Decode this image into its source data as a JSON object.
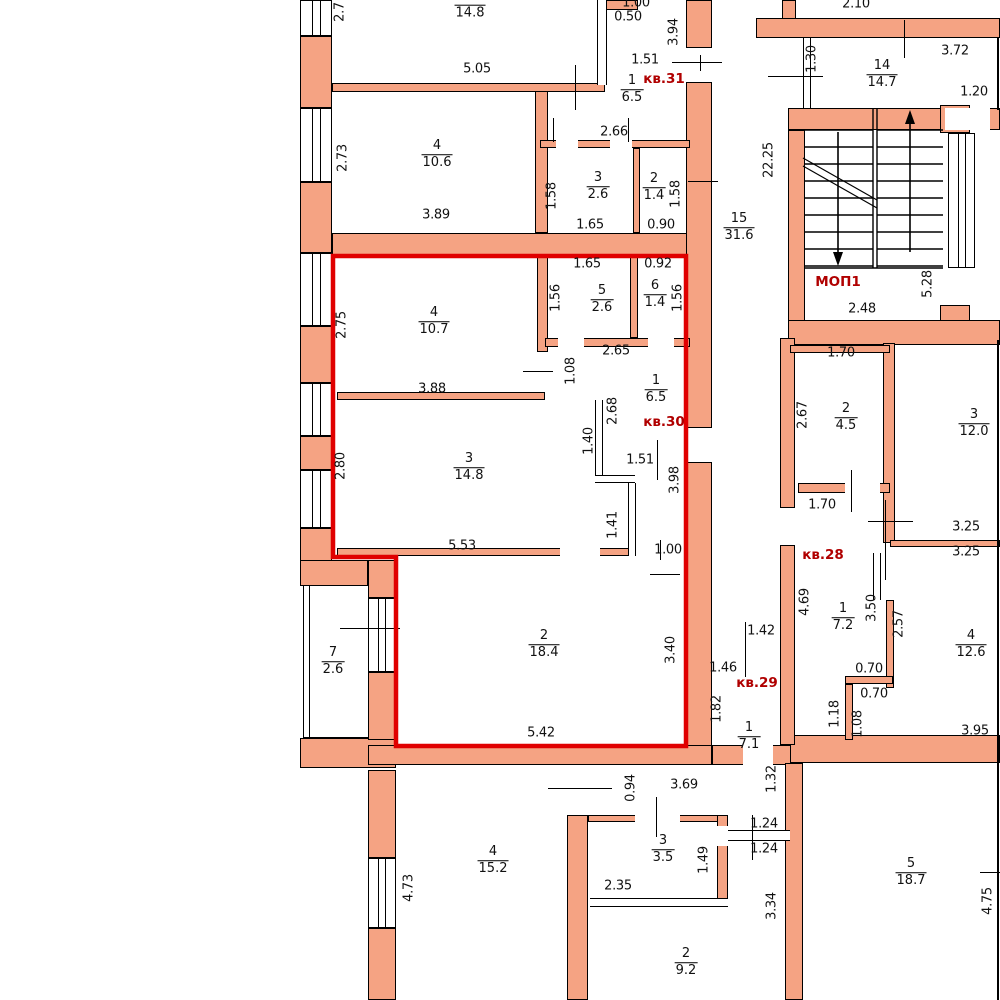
{
  "drawing": {
    "kind": "floor-plan",
    "language": "ru",
    "highlighted_apartment": "кв.30"
  },
  "colors": {
    "background": "#FFFFFF",
    "wall": "#F5A383",
    "outline": "#000000",
    "highlight": "#E00000",
    "tag": "#B00000"
  },
  "apartment_tags": [
    {
      "text": "кв.31",
      "x": 664,
      "y": 79
    },
    {
      "text": "кв.30",
      "x": 664,
      "y": 422
    },
    {
      "text": "кв.29",
      "x": 757,
      "y": 683
    },
    {
      "text": "кв.28",
      "x": 823,
      "y": 555
    },
    {
      "text": "МОП1",
      "x": 838,
      "y": 282
    }
  ],
  "room_labels": [
    {
      "num": "",
      "area": "14.8",
      "x": 470,
      "y": 13
    },
    {
      "num": "1",
      "area": "6.5",
      "x": 632,
      "y": 90
    },
    {
      "num": "4",
      "area": "10.6",
      "x": 437,
      "y": 155
    },
    {
      "num": "3",
      "area": "2.6",
      "x": 598,
      "y": 187
    },
    {
      "num": "2",
      "area": "1.4",
      "x": 654,
      "y": 188
    },
    {
      "num": "14",
      "area": "14.7",
      "x": 882,
      "y": 75
    },
    {
      "num": "15",
      "area": "31.6",
      "x": 739,
      "y": 228
    },
    {
      "num": "5",
      "area": "2.6",
      "x": 602,
      "y": 300
    },
    {
      "num": "6",
      "area": "1.4",
      "x": 655,
      "y": 295
    },
    {
      "num": "4",
      "area": "10.7",
      "x": 434,
      "y": 322
    },
    {
      "num": "1",
      "area": "6.5",
      "x": 656,
      "y": 390
    },
    {
      "num": "3",
      "area": "14.8",
      "x": 469,
      "y": 468
    },
    {
      "num": "2",
      "area": "18.4",
      "x": 544,
      "y": 645
    },
    {
      "num": "7",
      "area": "2.6",
      "x": 333,
      "y": 662
    },
    {
      "num": "2",
      "area": "4.5",
      "x": 846,
      "y": 418
    },
    {
      "num": "3",
      "area": "12.0",
      "x": 974,
      "y": 424
    },
    {
      "num": "1",
      "area": "7.2",
      "x": 843,
      "y": 618
    },
    {
      "num": "4",
      "area": "12.6",
      "x": 971,
      "y": 645
    },
    {
      "num": "1",
      "area": "7.1",
      "x": 749,
      "y": 737
    },
    {
      "num": "4",
      "area": "15.2",
      "x": 493,
      "y": 861
    },
    {
      "num": "3",
      "area": "3.5",
      "x": 663,
      "y": 850
    },
    {
      "num": "2",
      "area": "9.2",
      "x": 686,
      "y": 963
    },
    {
      "num": "5",
      "area": "18.7",
      "x": 911,
      "y": 873
    }
  ],
  "dim_labels": [
    {
      "text": "1.00",
      "x": 636,
      "y": 3,
      "rot": false
    },
    {
      "text": "0.50",
      "x": 628,
      "y": 17,
      "rot": false
    },
    {
      "text": "3.94",
      "x": 674,
      "y": 32,
      "rot": true
    },
    {
      "text": "1.51",
      "x": 645,
      "y": 60,
      "rot": false
    },
    {
      "text": "2.7",
      "x": 340,
      "y": 12,
      "rot": true
    },
    {
      "text": "5.05",
      "x": 477,
      "y": 69,
      "rot": false
    },
    {
      "text": "2.66",
      "x": 614,
      "y": 132,
      "rot": false
    },
    {
      "text": "2.73",
      "x": 343,
      "y": 158,
      "rot": true
    },
    {
      "text": "3.89",
      "x": 436,
      "y": 215,
      "rot": false
    },
    {
      "text": "1.58",
      "x": 552,
      "y": 196,
      "rot": true
    },
    {
      "text": "1.65",
      "x": 590,
      "y": 225,
      "rot": false
    },
    {
      "text": "0.90",
      "x": 661,
      "y": 225,
      "rot": false
    },
    {
      "text": "1.58",
      "x": 676,
      "y": 194,
      "rot": true
    },
    {
      "text": "2.10",
      "x": 856,
      "y": 4,
      "rot": false
    },
    {
      "text": "1.30",
      "x": 812,
      "y": 59,
      "rot": true
    },
    {
      "text": "3.72",
      "x": 955,
      "y": 51,
      "rot": false
    },
    {
      "text": "1.20",
      "x": 974,
      "y": 92,
      "rot": false
    },
    {
      "text": "22.25",
      "x": 769,
      "y": 160,
      "rot": true
    },
    {
      "text": "2.48",
      "x": 862,
      "y": 309,
      "rot": false
    },
    {
      "text": "5.28",
      "x": 928,
      "y": 284,
      "rot": true
    },
    {
      "text": "1.65",
      "x": 587,
      "y": 264,
      "rot": false
    },
    {
      "text": "0.92",
      "x": 658,
      "y": 264,
      "rot": false
    },
    {
      "text": "1.56",
      "x": 556,
      "y": 298,
      "rot": true
    },
    {
      "text": "1.56",
      "x": 678,
      "y": 298,
      "rot": true
    },
    {
      "text": "2.75",
      "x": 342,
      "y": 325,
      "rot": true
    },
    {
      "text": "2.65",
      "x": 616,
      "y": 351,
      "rot": false
    },
    {
      "text": "3.88",
      "x": 432,
      "y": 389,
      "rot": false
    },
    {
      "text": "1.08",
      "x": 571,
      "y": 371,
      "rot": true
    },
    {
      "text": "2.68",
      "x": 613,
      "y": 411,
      "rot": true
    },
    {
      "text": "2.80",
      "x": 341,
      "y": 466,
      "rot": true
    },
    {
      "text": "1.40",
      "x": 589,
      "y": 441,
      "rot": true
    },
    {
      "text": "1.51",
      "x": 640,
      "y": 460,
      "rot": false
    },
    {
      "text": "3.98",
      "x": 675,
      "y": 480,
      "rot": true
    },
    {
      "text": "1.41",
      "x": 613,
      "y": 525,
      "rot": true
    },
    {
      "text": "5.53",
      "x": 462,
      "y": 546,
      "rot": false
    },
    {
      "text": "1.00",
      "x": 668,
      "y": 550,
      "rot": false
    },
    {
      "text": "3.40",
      "x": 671,
      "y": 650,
      "rot": true
    },
    {
      "text": "5.42",
      "x": 541,
      "y": 733,
      "rot": false
    },
    {
      "text": "1.42",
      "x": 761,
      "y": 631,
      "rot": false
    },
    {
      "text": "1.46",
      "x": 723,
      "y": 668,
      "rot": false
    },
    {
      "text": "1.82",
      "x": 717,
      "y": 709,
      "rot": true
    },
    {
      "text": "1.32",
      "x": 772,
      "y": 779,
      "rot": true
    },
    {
      "text": "0.94",
      "x": 631,
      "y": 788,
      "rot": true
    },
    {
      "text": "3.69",
      "x": 684,
      "y": 785,
      "rot": false
    },
    {
      "text": "4.73",
      "x": 409,
      "y": 888,
      "rot": true
    },
    {
      "text": "2.35",
      "x": 618,
      "y": 886,
      "rot": false
    },
    {
      "text": "1.49",
      "x": 704,
      "y": 860,
      "rot": true
    },
    {
      "text": "1.24",
      "x": 764,
      "y": 824,
      "rot": false
    },
    {
      "text": "1.24",
      "x": 764,
      "y": 849,
      "rot": false
    },
    {
      "text": "3.34",
      "x": 772,
      "y": 906,
      "rot": true
    },
    {
      "text": "1.70",
      "x": 841,
      "y": 353,
      "rot": false
    },
    {
      "text": "2.67",
      "x": 803,
      "y": 415,
      "rot": true
    },
    {
      "text": "1.70",
      "x": 822,
      "y": 505,
      "rot": false
    },
    {
      "text": "3.25",
      "x": 966,
      "y": 527,
      "rot": false
    },
    {
      "text": "3.25",
      "x": 966,
      "y": 552,
      "rot": false
    },
    {
      "text": "4.69",
      "x": 805,
      "y": 602,
      "rot": true
    },
    {
      "text": "3.50",
      "x": 872,
      "y": 608,
      "rot": true
    },
    {
      "text": "2.57",
      "x": 899,
      "y": 624,
      "rot": true
    },
    {
      "text": "0.70",
      "x": 869,
      "y": 669,
      "rot": false
    },
    {
      "text": "0.70",
      "x": 874,
      "y": 694,
      "rot": false
    },
    {
      "text": "1.18",
      "x": 835,
      "y": 714,
      "rot": true
    },
    {
      "text": "1.08",
      "x": 858,
      "y": 724,
      "rot": true
    },
    {
      "text": "3.95",
      "x": 975,
      "y": 731,
      "rot": false
    },
    {
      "text": "4.75",
      "x": 988,
      "y": 901,
      "rot": true
    }
  ]
}
